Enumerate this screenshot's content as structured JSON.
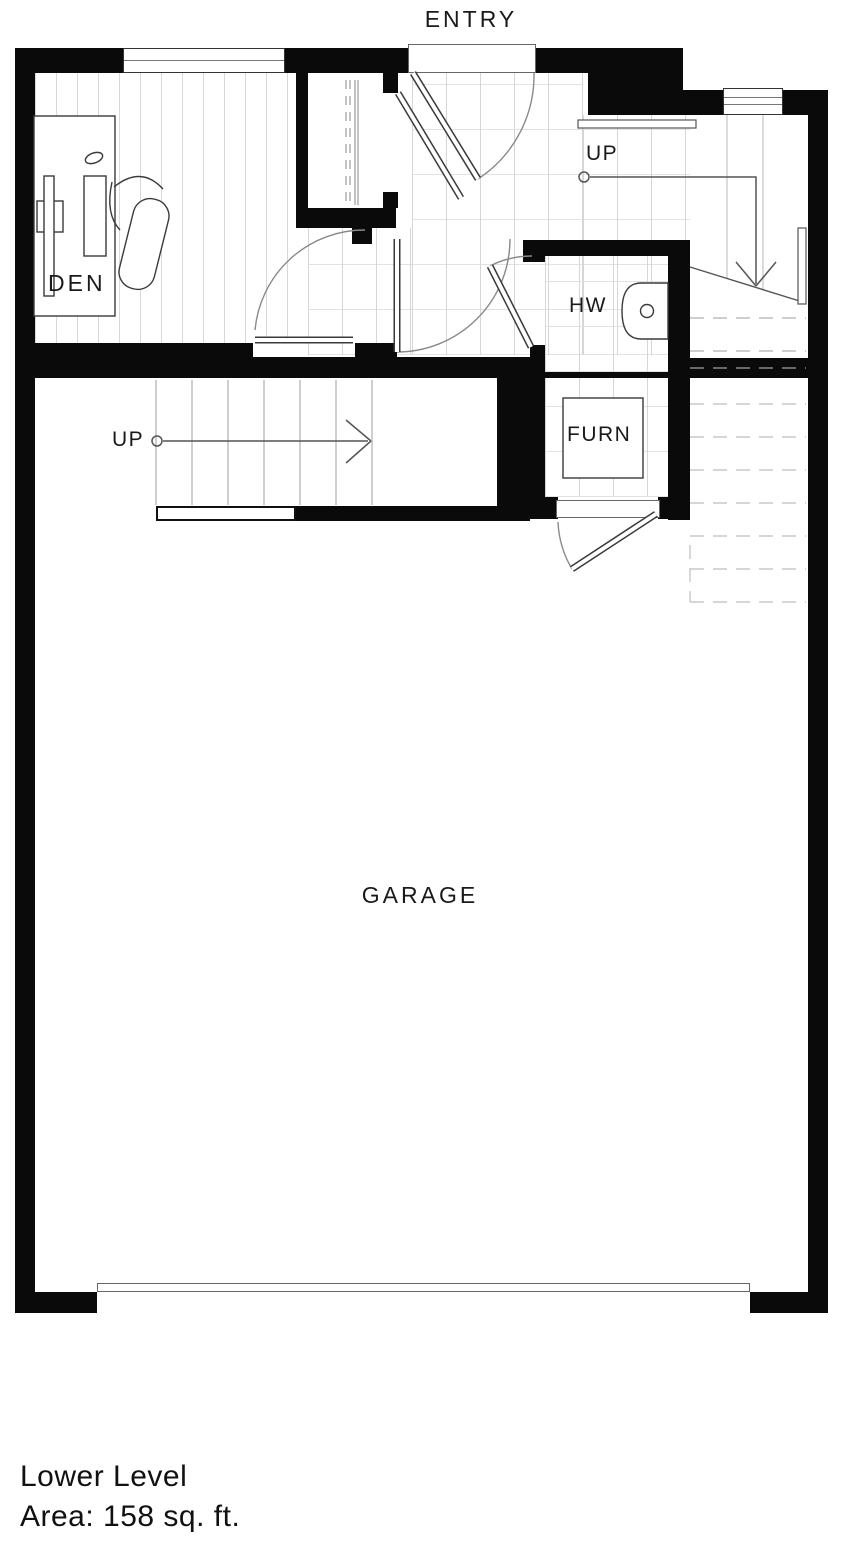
{
  "plan": {
    "labels": {
      "title": "Lower Level",
      "area": "Area: 158 sq. ft.",
      "entry": "ENTRY",
      "den": "DEN",
      "hw": "HW",
      "furn": "FURN",
      "garage": "GARAGE",
      "up_hall": "UP",
      "up_garage": "UP"
    },
    "rooms": [
      {
        "id": "den",
        "label": "DEN",
        "floor": "wood-plank",
        "furniture": [
          "desk",
          "office-chair"
        ]
      },
      {
        "id": "entry",
        "label": "ENTRY",
        "floor": "tile",
        "features": [
          "entry-door",
          "coat-closet"
        ]
      },
      {
        "id": "hw",
        "label": "HW",
        "floor": "tile",
        "fixture": "water-heater"
      },
      {
        "id": "furn",
        "label": "FURN",
        "floor": "tile",
        "fixture": "furnace"
      },
      {
        "id": "garage",
        "label": "GARAGE",
        "floor": "concrete",
        "features": [
          "garage-door",
          "stair-up"
        ]
      }
    ],
    "stairs": [
      {
        "id": "hall-stair",
        "label": "UP",
        "direction": "right-then-down",
        "note": "dashed portion overhead"
      },
      {
        "id": "garage-stair",
        "label": "UP",
        "direction": "right"
      }
    ],
    "windows": 2,
    "colors": {
      "wall": "#0a0a0a",
      "door-line": "#3a3a3a",
      "arc-line": "#8a8a8a",
      "floor-grid": "#d6d6d6",
      "overhead-dash": "#c8c8c8",
      "text": "#1a1a1a"
    }
  }
}
